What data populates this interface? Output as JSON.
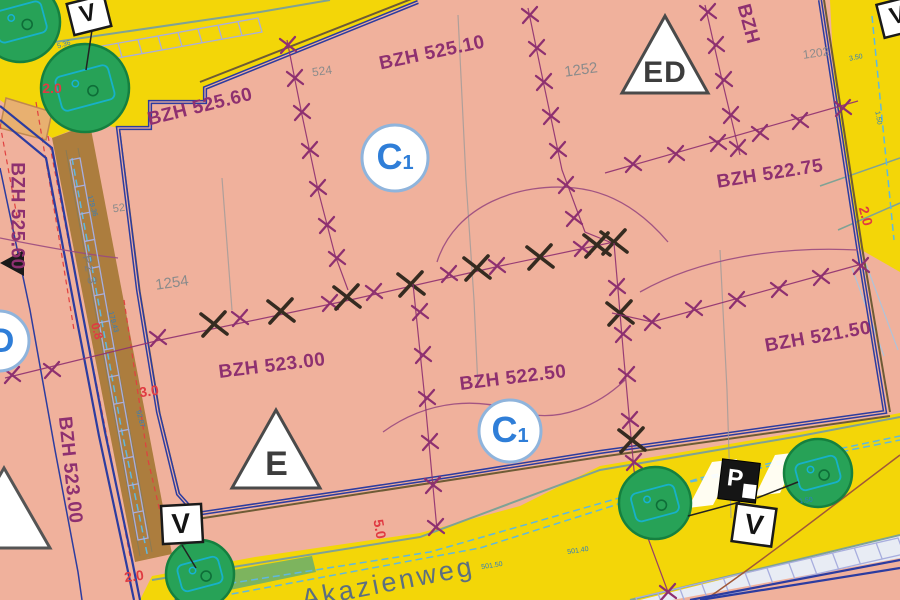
{
  "colors": {
    "salmon": "#f0b19c",
    "roadYellow": "#f3d608",
    "boundaryBlue": "#2c3ca0",
    "markPurple": "#8e3070",
    "markBlack": "#352b20",
    "treeGreen": "#27a257",
    "treeTeal": "#16b2d6",
    "pathBrown": "#ac7d3e",
    "dimRed": "#e03a42",
    "surveyBlue": "#2f7ec0",
    "parcelGray": "#8b8b8b",
    "streetSlate": "#5c6f80",
    "khaki": "#6e5b35",
    "ladderLav": "#a8aede",
    "dashBlue": "#5fb8e0",
    "tealEdge": "#7fa295"
  },
  "map": {
    "street": {
      "name": "Akazienweg"
    },
    "zones": {
      "c1": {
        "main": "C",
        "sub": "1"
      },
      "d": {
        "label": "D"
      },
      "ed": {
        "label": "ED"
      },
      "e": {
        "label": "E"
      }
    },
    "signs": {
      "v": "V",
      "p": "P"
    },
    "path_label": "Pz 3",
    "elevations": [
      {
        "text": "BZH 525.60"
      },
      {
        "text": "BZH 525.10"
      },
      {
        "text": "BZH 522.75"
      },
      {
        "text": "BZH 523.00"
      },
      {
        "text": "BZH 522.50"
      },
      {
        "text": "BZH 521.50"
      },
      {
        "text": "BZH 525.60"
      },
      {
        "text": "BZH 523.00"
      },
      {
        "text": "BZH"
      }
    ],
    "parcels": [
      {
        "text": "524"
      },
      {
        "text": "1252"
      },
      {
        "text": "1202"
      },
      {
        "text": "1254"
      },
      {
        "text": "52"
      }
    ],
    "dimensions": [
      {
        "text": "2.0"
      },
      {
        "text": "0.8"
      },
      {
        "text": "3.0"
      },
      {
        "text": "2.0"
      },
      {
        "text": "5.0"
      },
      {
        "text": "2.0"
      }
    ],
    "measurements": [
      {
        "text": "179.36"
      },
      {
        "text": "179.43"
      },
      {
        "text": "92.87"
      },
      {
        "text": "501.50"
      },
      {
        "text": "501.40"
      },
      {
        "text": "1.50"
      },
      {
        "text": "3.50"
      },
      {
        "text": "5.36"
      },
      {
        "text": "1.50"
      }
    ],
    "geometry": {
      "x_chains": [
        {
          "name": "chain-top-left",
          "line": [
            [
              287,
              40
            ],
            [
              302,
              115
            ],
            [
              318,
              190
            ],
            [
              335,
              255
            ],
            [
              348,
              290
            ]
          ],
          "marks": [
            [
              288,
              45,
              "p"
            ],
            [
              295,
              78,
              "p"
            ],
            [
              302,
              112,
              "p"
            ],
            [
              310,
              150,
              "p"
            ],
            [
              318,
              188,
              "p"
            ],
            [
              327,
              225,
              "p"
            ],
            [
              337,
              258,
              "p"
            ]
          ]
        },
        {
          "name": "chain-top-mid",
          "line": [
            [
              528,
              8
            ],
            [
              545,
              90
            ],
            [
              562,
              170
            ],
            [
              585,
              232
            ],
            [
              612,
              243
            ]
          ],
          "marks": [
            [
              530,
              15,
              "p"
            ],
            [
              537,
              48,
              "p"
            ],
            [
              544,
              82,
              "p"
            ],
            [
              551,
              116,
              "p"
            ],
            [
              558,
              150,
              "p"
            ],
            [
              566,
              185,
              "p"
            ],
            [
              574,
              218,
              "p"
            ]
          ]
        },
        {
          "name": "chain-top-right",
          "line": [
            [
              705,
              5
            ],
            [
              722,
              80
            ],
            [
              740,
              155
            ]
          ],
          "marks": [
            [
              708,
              12,
              "p"
            ],
            [
              716,
              45,
              "p"
            ],
            [
              724,
              80,
              "p"
            ],
            [
              731,
              115,
              "p"
            ],
            [
              738,
              148,
              "p"
            ]
          ]
        },
        {
          "name": "chain-northeast",
          "line": [
            [
              605,
              173
            ],
            [
              858,
              101
            ]
          ],
          "marks": [
            [
              633,
              164,
              "p"
            ],
            [
              676,
              154,
              "p"
            ],
            [
              718,
              143,
              "p"
            ],
            [
              760,
              133,
              "p"
            ],
            [
              800,
              121,
              "p"
            ],
            [
              843,
              108,
              "p"
            ]
          ]
        },
        {
          "name": "chain-main-horizontal",
          "line": [
            [
              5,
              378
            ],
            [
              160,
              340
            ],
            [
              350,
              300
            ],
            [
              500,
              266
            ],
            [
              614,
              242
            ]
          ],
          "marks": [
            [
              12,
              375,
              "p"
            ],
            [
              52,
              370,
              "p"
            ],
            [
              158,
              338,
              "p"
            ],
            [
              214,
              324,
              "b"
            ],
            [
              240,
              318,
              "p"
            ],
            [
              281,
              311,
              "b"
            ],
            [
              330,
              303,
              "p"
            ],
            [
              347,
              297,
              "b"
            ],
            [
              374,
              292,
              "p"
            ],
            [
              411,
              284,
              "b"
            ],
            [
              449,
              274,
              "p"
            ],
            [
              477,
              268,
              "b"
            ],
            [
              497,
              266,
              "p"
            ],
            [
              540,
              257,
              "b"
            ],
            [
              582,
              248,
              "p"
            ],
            [
              597,
              245,
              "b"
            ],
            [
              614,
              242,
              "b"
            ]
          ]
        },
        {
          "name": "chain-center-vertical",
          "line": [
            [
              413,
              284
            ],
            [
              425,
              400
            ],
            [
              437,
              530
            ]
          ],
          "marks": [
            [
              420,
              312,
              "p"
            ],
            [
              423,
              355,
              "p"
            ],
            [
              427,
              398,
              "p"
            ],
            [
              430,
              442,
              "p"
            ],
            [
              433,
              485,
              "p"
            ],
            [
              436,
              527,
              "p"
            ]
          ]
        },
        {
          "name": "chain-right-vertical",
          "line": [
            [
              614,
              243
            ],
            [
              624,
              360
            ],
            [
              634,
              470
            ],
            [
              645,
              530
            ],
            [
              668,
              592
            ]
          ],
          "marks": [
            [
              617,
              287,
              "p"
            ],
            [
              620,
              313,
              "b"
            ],
            [
              623,
              334,
              "p"
            ],
            [
              627,
              375,
              "p"
            ],
            [
              630,
              420,
              "p"
            ],
            [
              632,
              440,
              "b"
            ],
            [
              634,
              462,
              "p"
            ],
            [
              668,
              592,
              "p"
            ]
          ]
        },
        {
          "name": "chain-southeast",
          "line": [
            [
              612,
              313
            ],
            [
              652,
              322
            ],
            [
              862,
              264
            ]
          ],
          "marks": [
            [
              652,
              322,
              "p"
            ],
            [
              694,
              309,
              "p"
            ],
            [
              737,
              300,
              "p"
            ],
            [
              779,
              289,
              "p"
            ],
            [
              821,
              277,
              "p"
            ],
            [
              861,
              266,
              "p"
            ]
          ]
        }
      ],
      "trees": [
        [
          20,
          22,
          40
        ],
        [
          85,
          88,
          44
        ],
        [
          200,
          574,
          34
        ],
        [
          655,
          503,
          36
        ],
        [
          818,
          473,
          34
        ]
      ],
      "ladders": [
        {
          "a": [
            58,
            54
          ],
          "b": [
            258,
            18
          ],
          "o": [
            4,
            14
          ],
          "n": 10
        },
        {
          "a": [
            636,
            598
          ],
          "b": [
            898,
            538
          ],
          "o": [
            6,
            16
          ],
          "n": 12
        },
        {
          "a": [
            70,
            160
          ],
          "b": [
            138,
            540
          ],
          "o": [
            10,
            -2
          ],
          "n": 14
        }
      ]
    }
  }
}
